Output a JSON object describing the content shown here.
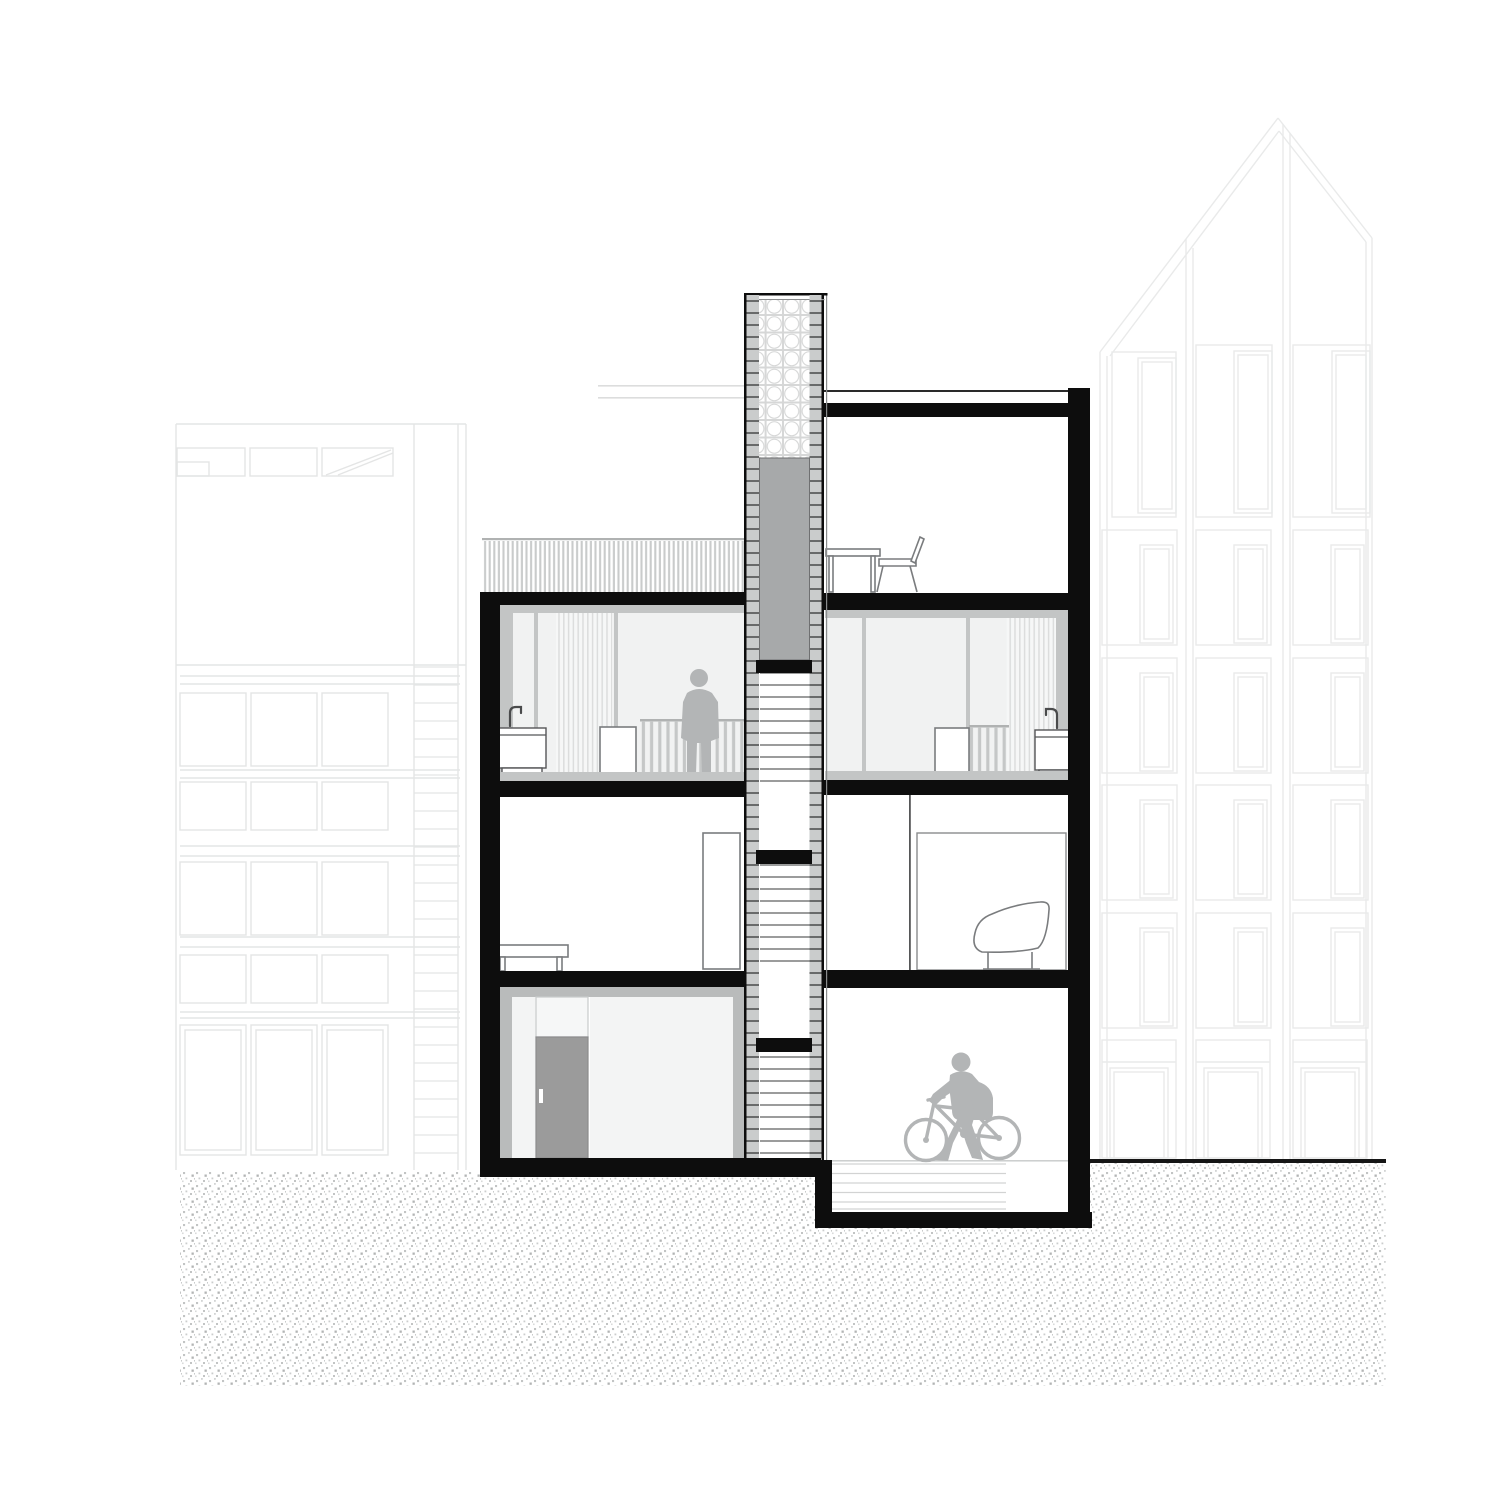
{
  "document": {
    "kind": "architectural-cross-section-drawing",
    "visible_text": []
  },
  "colors": {
    "paper": "#ffffff",
    "ink": "#0d0d0d",
    "silhouette": "#b3b5b6",
    "elevator": "#a7a9aa",
    "door": "#9b9b9b",
    "band": "#cacccc",
    "tick": "#3f3f3f",
    "glass": "#f1f2f2",
    "mullion": "#c3c5c5",
    "curtainline": "#dcdddd",
    "slat": "#c9cbcb",
    "furn": "#7a7c7e",
    "bgl": "#e4e5e5",
    "bgr": "#e9eaea",
    "tread": "#5f6161",
    "rampline": "#d2d3d3",
    "framegray": "#b9bbbb",
    "railtop": "#b0b2b2",
    "groundline": "#161616"
  },
  "scene": {
    "background_buildings": {
      "left": "neighbor-facade-window-grid",
      "right": "neighbor-facade-gabled"
    },
    "section_building": {
      "left_stack_levels": [
        "roof-terrace-balustrade",
        "upper-room-glazed",
        "middle-room",
        "ground-entry"
      ],
      "right_stack_levels": [
        "roof-level-room",
        "upper-room-glazed",
        "middle-room",
        "garage"
      ],
      "stair_core": {
        "glass_block_top": true,
        "elevator_block": true,
        "landings": 3,
        "tread_runs": 3
      }
    },
    "figures": [
      "standing-person",
      "person-walking-bicycle"
    ],
    "furniture": [
      "roof-table",
      "roof-chair",
      "sink-left",
      "sink-right",
      "cabinet-left",
      "cabinet-right",
      "bench",
      "armchair",
      "tall-cabinet",
      "entry-door"
    ],
    "ground": {
      "hatch_style": "stipple",
      "street_level_left": true,
      "sunken_garage_right": true
    }
  }
}
